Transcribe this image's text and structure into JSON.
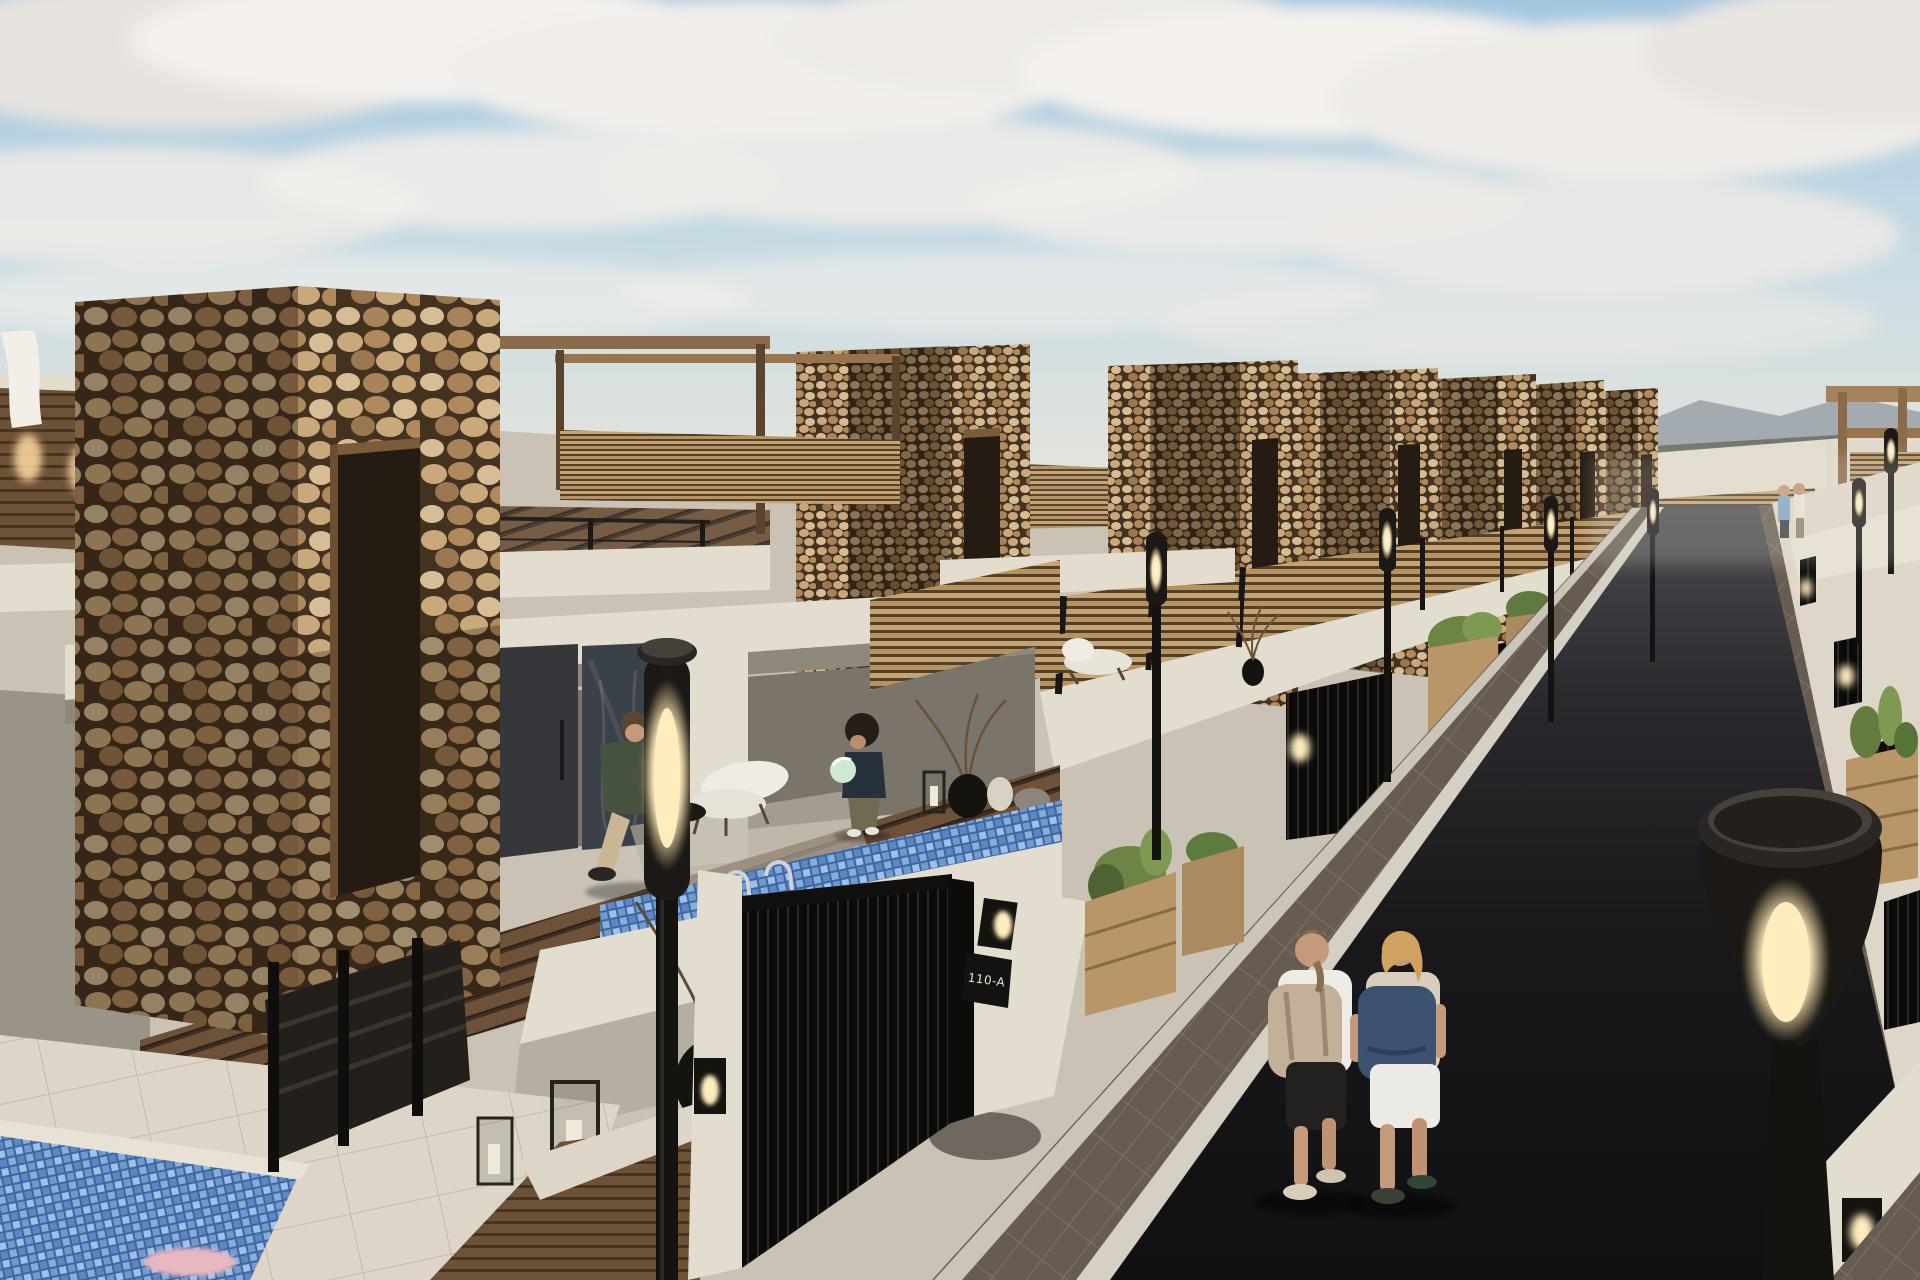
{
  "scene": {
    "type": "architectural-render",
    "title": "New-build villa street with pebble-stone entrance towers",
    "description": "Photorealistic 3D render of a residential street lined with white villas, stone-clad towers, wood-slat fences, private mosaic pools and modern street lamps at dusk; two people with backpacks walk away down the dark asphalt road.",
    "gate_plaque_text": "110-A"
  },
  "palette": {
    "sky_top": "#a3c6df",
    "sky_horizon": "#eae5d9",
    "cloud_white": "#f4f1ed",
    "cloud_grey": "#ddd8d4",
    "hills": "#99a0a8",
    "trees": "#6b7265",
    "street_far": "#4c4c50",
    "street_near": "#101013",
    "sidewalk": "#675d53",
    "curb": "#d6d0c4",
    "wall_lit": "#e3ddd0",
    "wall_mid": "#c9c2b5",
    "wall_warm": "#ded7c9",
    "wall_shadow": "#9d968b",
    "stone_light": "#d6bd96",
    "stone_mid": "#b08a5c",
    "grout": "#43321f",
    "window_dark": "#241b12",
    "wood_frame": "#7a5c3a",
    "fence_slat": "#c6a372",
    "fence_gap": "#51402c",
    "deck_plank": "#6d5138",
    "pool_base": "#3f669f",
    "pool_light": "#86aedd",
    "metal_black": "#1b1815",
    "glow": "#ffedbe",
    "greenery": "#6d8444",
    "skin": "#c49a7a",
    "tee_white": "#efece6",
    "capri_black": "#22211f",
    "backpack_tan": "#c3b098",
    "backpack_navy": "#3d5270",
    "shorts_white": "#eceae4",
    "jacket_green": "#47523f",
    "trousers_beige": "#cbb694",
    "ball_green": "#cfe8d2",
    "plaque_bg": "#141210",
    "plaque_text": "#e8e4da"
  },
  "objects": {
    "stone_towers_visible": 7,
    "street_lamps_visible": 9,
    "pools": [
      "terrace pool with blue mosaic tiles and steel ladder",
      "lower patio plunge pool with blue mosaic"
    ],
    "people": [
      {
        "id": "terrace-man",
        "description": "man in dark green jacket and beige trousers walking across wooden deck"
      },
      {
        "id": "terrace-child",
        "description": "child with dark curly hair holding a pale green ball beside the pool"
      },
      {
        "id": "street-walker-left",
        "description": "walker in white t-shirt, black capri pants and beige backpack"
      },
      {
        "id": "street-walker-right",
        "description": "blonde walker in patterned top, white shorts and navy backpack"
      },
      {
        "id": "distant-couple",
        "description": "two small figures at the far end of the street"
      }
    ],
    "vegetation": [
      "cactus planters along the sidewalk",
      "succulent planter boxes",
      "dry branch arrangements in vases"
    ],
    "furniture": [
      "white lounge chair on deck",
      "lounger on neighbouring terrace",
      "candle lanterns",
      "stone bowls and pots"
    ],
    "lighting": [
      "modern black street lamps with glowing oval windows",
      "warm wall lanterns beside each gate",
      "downlights on wood-slat wall"
    ]
  }
}
